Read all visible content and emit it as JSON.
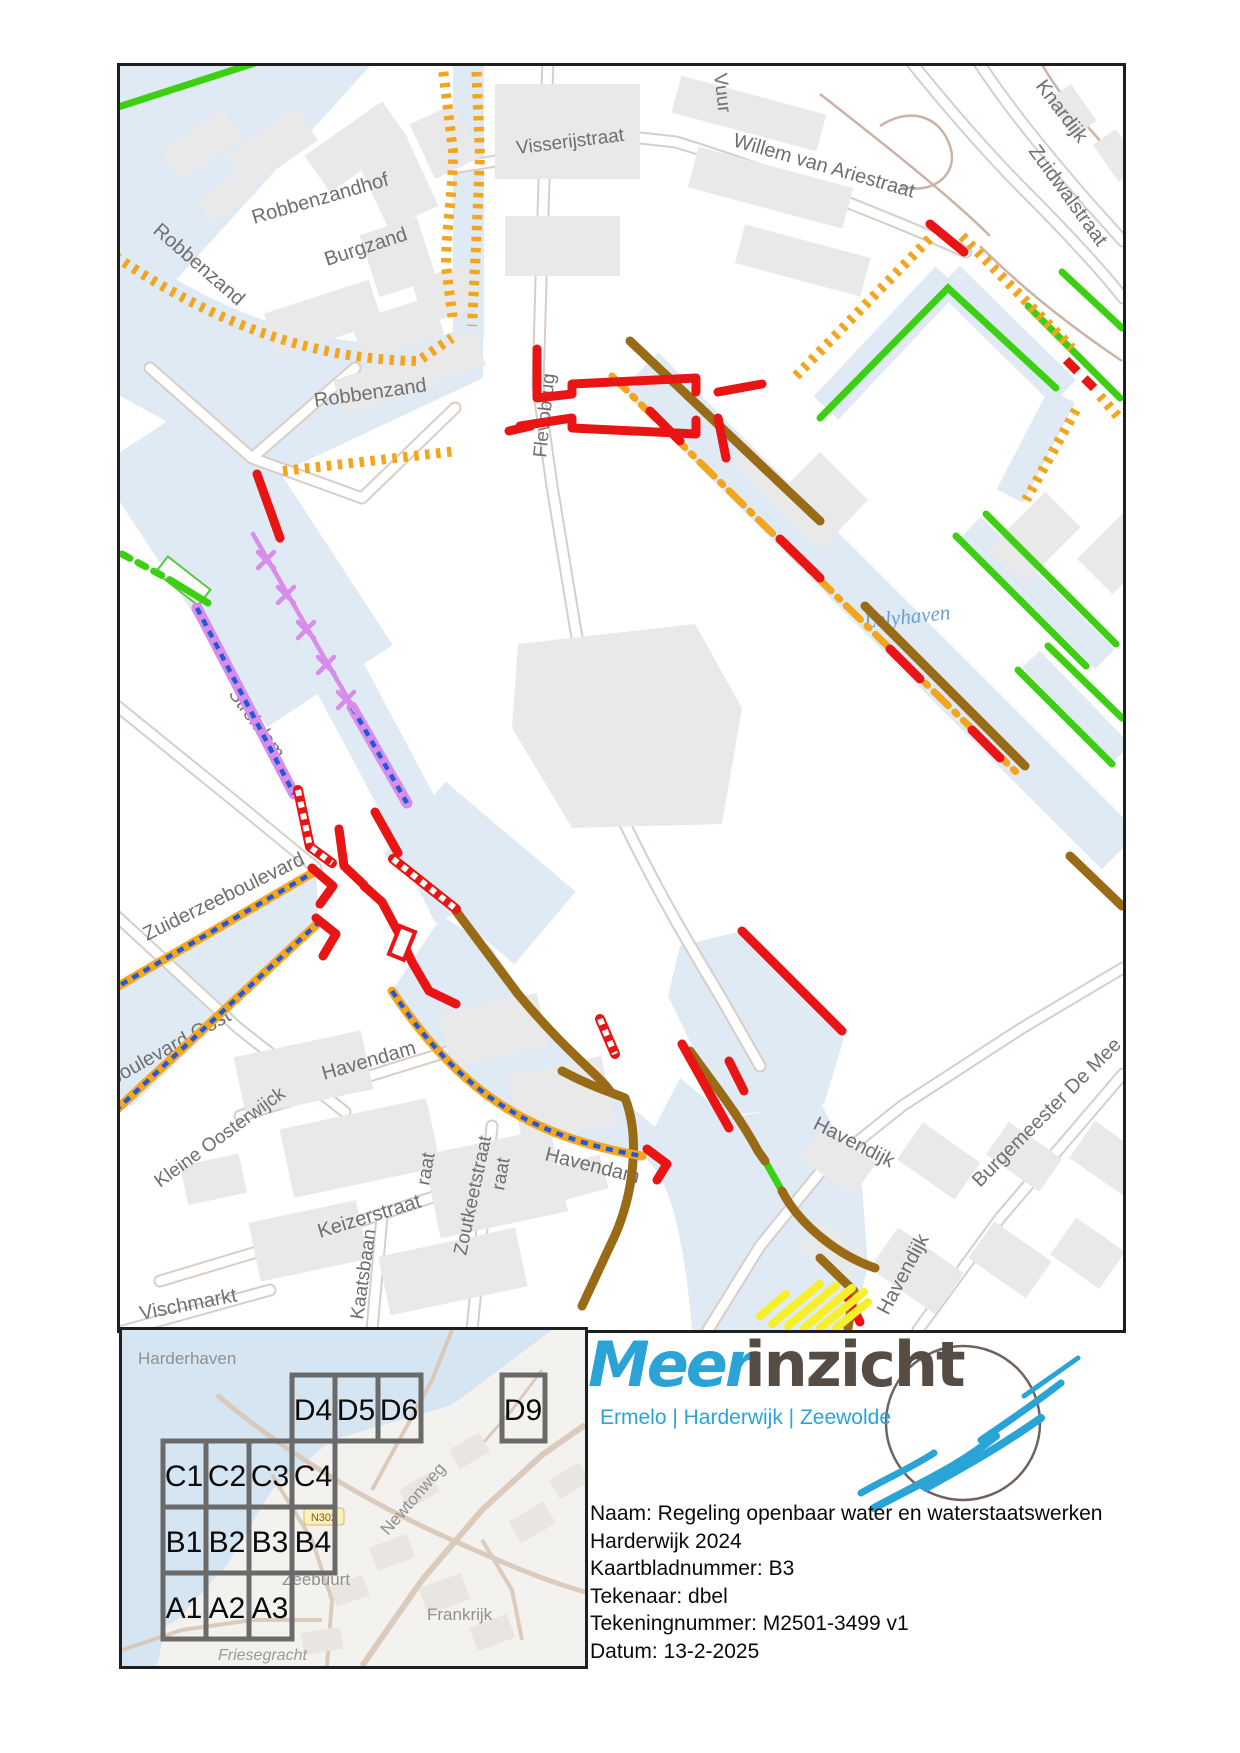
{
  "map": {
    "street_labels": [
      "Visserijstraat",
      "Willem van Ariestraat",
      "Knardijk",
      "Zuidwalstraat",
      "Vuur",
      "Robbenzandhof",
      "Robbenzand",
      "Burgzand",
      "Robbenzand",
      "Flevobrug",
      "Strekdam",
      "Zuiderzeeboulevard",
      "Strandboulevard Oost",
      "Kleine Oosterwijck",
      "Havendam",
      "Keizerstraat",
      "Zoutkeetstraat",
      "Havendam",
      "Kaatsbaan",
      "Vischmarkt",
      "raat",
      "raat",
      "Havendijk",
      "Havendijk",
      "Burgemeester De Mee"
    ],
    "water_label": "Lelyhaven",
    "line_colors": {
      "water": "#dfeaf4",
      "green": "#3ccf12",
      "orange": "#f2a51d",
      "red": "#e91414",
      "brown": "#9a6b17",
      "purple": "#d78de9",
      "blue": "#2159d8",
      "yellow": "#f8ef2b"
    }
  },
  "minimap": {
    "place_labels": [
      "Harderhaven",
      "Zeebuurt",
      "Frankrijk",
      "Friesegracht",
      "Newtonweg"
    ],
    "road_badge": "N302",
    "cells": [
      "D4",
      "D5",
      "D6",
      "D9",
      "C1",
      "C2",
      "C3",
      "C4",
      "B1",
      "B2",
      "B3",
      "B4",
      "A1",
      "A2",
      "A3"
    ]
  },
  "title_block": {
    "brand_part1": "Meer",
    "brand_part2": "inzicht",
    "brand_subtitle": "Ermelo | Harderwijk | Zeewolde",
    "info_lines": [
      "Naam: Regeling openbaar water en waterstaatswerken",
      "Harderwijk 2024",
      "Kaartbladnummer: B3",
      "Tekenaar: dbel",
      "Tekeningnummer: M2501-3499 v1",
      "Datum: 13-2-2025"
    ],
    "logo_colors": {
      "blue": "#2aa4d6",
      "brown": "#564c46"
    }
  }
}
